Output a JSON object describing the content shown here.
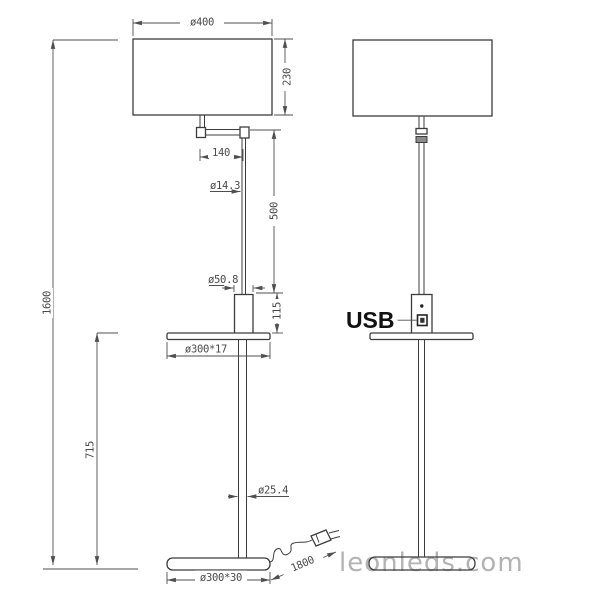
{
  "dimensions": {
    "shade_diameter": "ø400",
    "shade_height": "230",
    "total_height": "1600",
    "arm_length": "140",
    "rod_diameter": "ø14.3",
    "rod_length": "500",
    "column_diameter": "ø50.8",
    "column_height": "115",
    "table_size": "ø300*17",
    "table_height": "715",
    "pole_diameter": "ø25.4",
    "base_size": "ø300*30",
    "cable_length": "1800"
  },
  "labels": {
    "usb": "USB"
  },
  "watermark": {
    "text": "leonleds.com",
    "color": "#b3b3b3"
  },
  "colors": {
    "outline": "#3c3c3c",
    "dimension": "#4f4f4f",
    "usb_label": "#111111",
    "background": "#ffffff"
  }
}
